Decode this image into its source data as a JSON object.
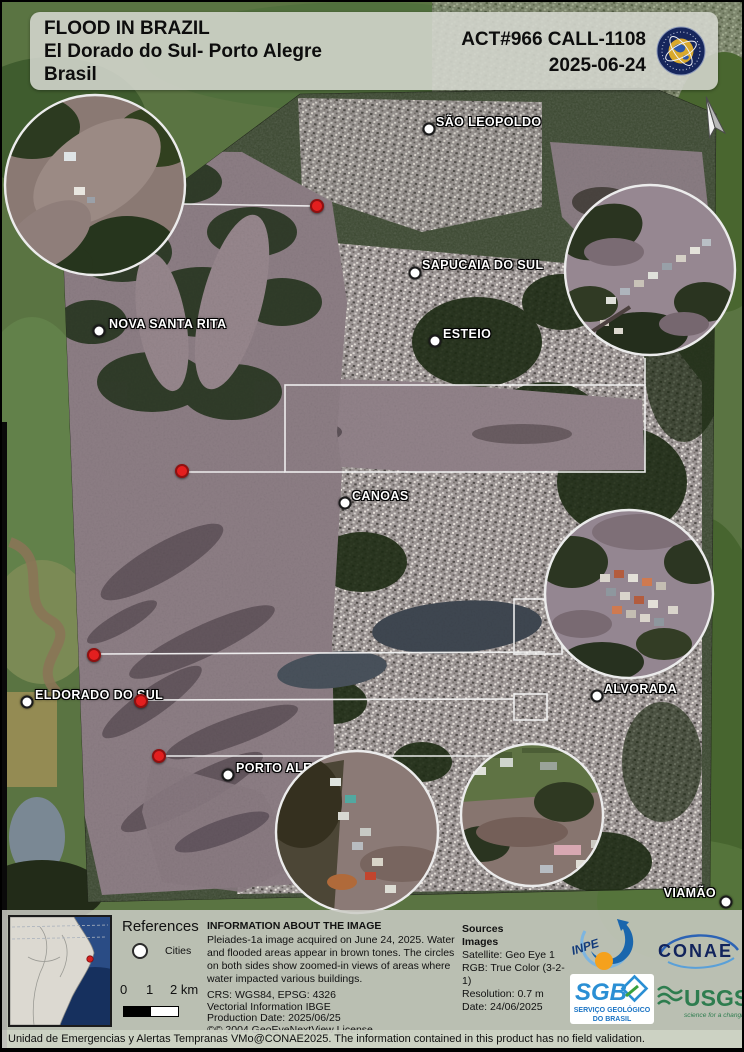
{
  "title_block": {
    "line1": "FLOOD IN BRAZIL",
    "line2": "El Dorado do Sul- Porto Alegre",
    "line3": "Brasil",
    "act_call": "ACT#966 CALL-1108",
    "date": "2025-06-24"
  },
  "map": {
    "cities": [
      {
        "name": "SÃO LEOPOLDO"
      },
      {
        "name": "SAPUCAIA DO SUL"
      },
      {
        "name": "NOVA SANTA RITA"
      },
      {
        "name": "ESTEIO"
      },
      {
        "name": "CANOAS"
      },
      {
        "name": "ELDORADO DO SUL"
      },
      {
        "name": "ALVORADA"
      },
      {
        "name": "PORTO ALEGRE"
      },
      {
        "name": "VIAMÃO"
      }
    ],
    "zoom_insets_count": "5",
    "impact_markers_count": "5"
  },
  "legend": {
    "references_title": "References",
    "cities_label": "Cities",
    "scale": {
      "t0": "0",
      "t1": "1",
      "t2": "2 km"
    }
  },
  "info": {
    "heading": "INFORMATION ABOUT THE IMAGE",
    "body": "Pleiades-1a image acquired on June 24, 2025. Water and flooded areas appear in brown tones. The circles on both sides show zoomed-in views of areas where water impacted various buildings.",
    "crs": "CRS: WGS84, EPSG: 4326",
    "vector": "Vectorial Information IBGE",
    "production": "Production Date: 2025/06/25",
    "license": "©© 2004 GeoEyeNextView License"
  },
  "sources": {
    "heading": "Sources",
    "subheading": "Images",
    "satellite": "Satellite: Geo Eye 1",
    "rgb": "RGB: True Color (3-2-1)",
    "resolution": "Resolution: 0.7 m",
    "date": "Date: 24/06/2025"
  },
  "logos": {
    "inpe": "INPE",
    "conae": "CONAE",
    "sgb": "SGB",
    "sgb_sub1": "SERVIÇO GEOLÓGICO",
    "sgb_sub2": "DO BRASIL",
    "usgs": "USGS",
    "usgs_tagline": "science for a changing world"
  },
  "status_bar": {
    "text": "Unidad de Emergencias y Alertas Tempranas VMo@CONAE2025. The information contained in this product has no field validation."
  },
  "colors": {
    "flood_water": "#8d7e85",
    "urban": "#a19a99",
    "vegetation": "#39462e",
    "marker_red": "#e31f1f",
    "panel_bg": "#cbcdc6"
  }
}
